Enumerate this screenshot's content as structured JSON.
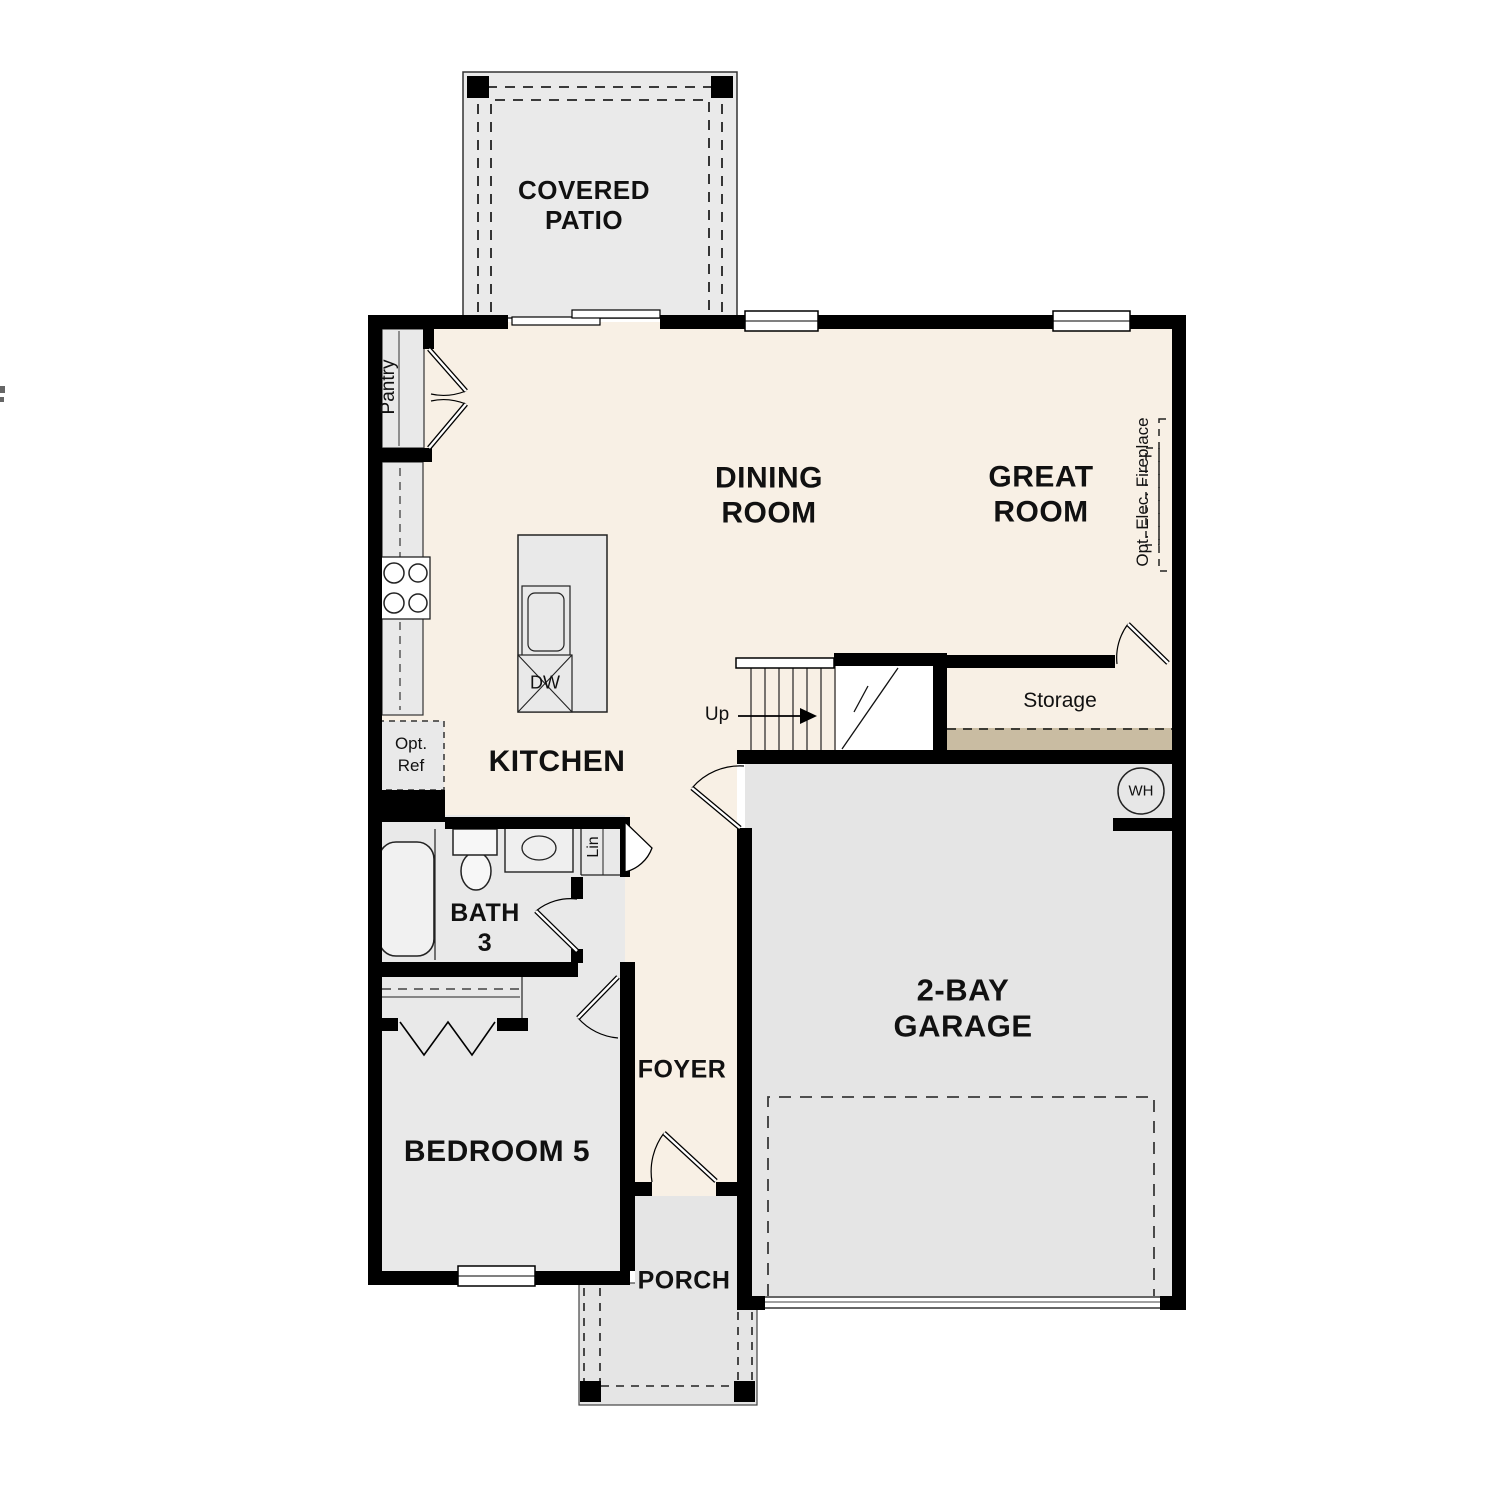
{
  "labels": {
    "covered_patio": "COVERED PATIO",
    "dining_room": "DINING ROOM",
    "great_room": "GREAT ROOM",
    "kitchen": "KITCHEN",
    "pantry": "Pantry",
    "opt_ref": "Opt. Ref",
    "dw": "DW",
    "up": "Up",
    "storage": "Storage",
    "opt_elec_fireplace": "Opt. Elec. Fireplace",
    "wh": "WH",
    "bath_3": "BATH 3",
    "lin": "Lin",
    "foyer": "FOYER",
    "bedroom_5": "BEDROOM 5",
    "porch": "PORCH",
    "garage": "2-BAY GARAGE"
  },
  "colors": {
    "background": "#FFFFFF",
    "floor_cream": "#F8F0E5",
    "room_gray": "#E9E9E9",
    "garage_gray": "#E5E5E5",
    "patio_gray": "#EAEAEA",
    "storage_tan": "#C9BCA2",
    "wall": "#000000"
  }
}
